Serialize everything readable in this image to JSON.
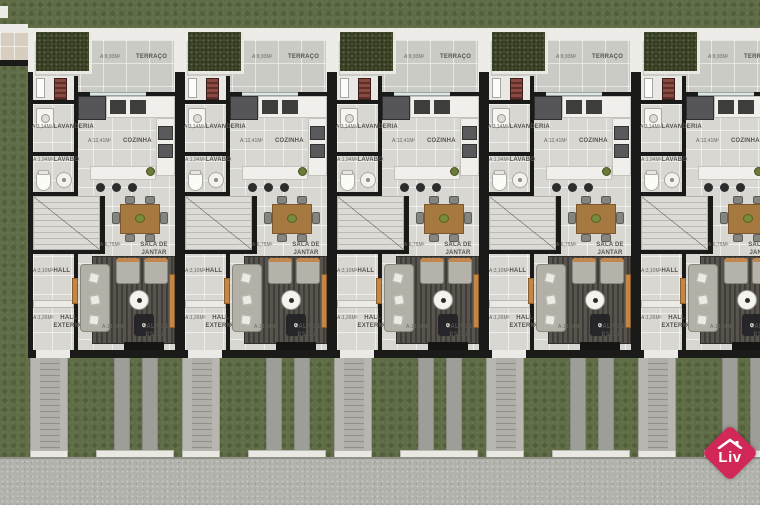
{
  "plan": {
    "type": "residential-townhouse-floor-plan",
    "units_visible": 5,
    "rooms": {
      "terraco": {
        "name": "TERRAÇO",
        "area": "A:8,93M²"
      },
      "lavanderia": {
        "name": "LAVANDERIA",
        "area": "A:3,14M²"
      },
      "cozinha": {
        "name": "COZINHA",
        "area": "A:12,41M²"
      },
      "lavabo": {
        "name": "LAVABO",
        "area": "A:1,94M²"
      },
      "sala_de_jantar": {
        "name": "SALA DE JANTAR",
        "area": "A:6,75M²"
      },
      "hall": {
        "name": "HALL",
        "area": "A:3,10M²"
      },
      "hall_externo": {
        "name": "HALL EXTERNO",
        "area": "A:1,26M²"
      },
      "sala_de_estar": {
        "name": "SALA DE ESTAR",
        "area": "A:13,16M²"
      }
    },
    "units": [
      {
        "index": 1
      },
      {
        "index": 2
      },
      {
        "index": 3
      },
      {
        "index": 4
      },
      {
        "index": 5
      }
    ]
  },
  "logo": {
    "text": "Liv",
    "color": "#d22858"
  },
  "colors": {
    "grass": "#5f6d47",
    "garden": "#454e2d",
    "floor_tile": "#d8d7d2",
    "wall": "#1a1a19",
    "wood_accent": "#c28647",
    "dining_table": "#a5793f",
    "sidewalk": "#b2b2ac",
    "brand": "#d22858"
  }
}
